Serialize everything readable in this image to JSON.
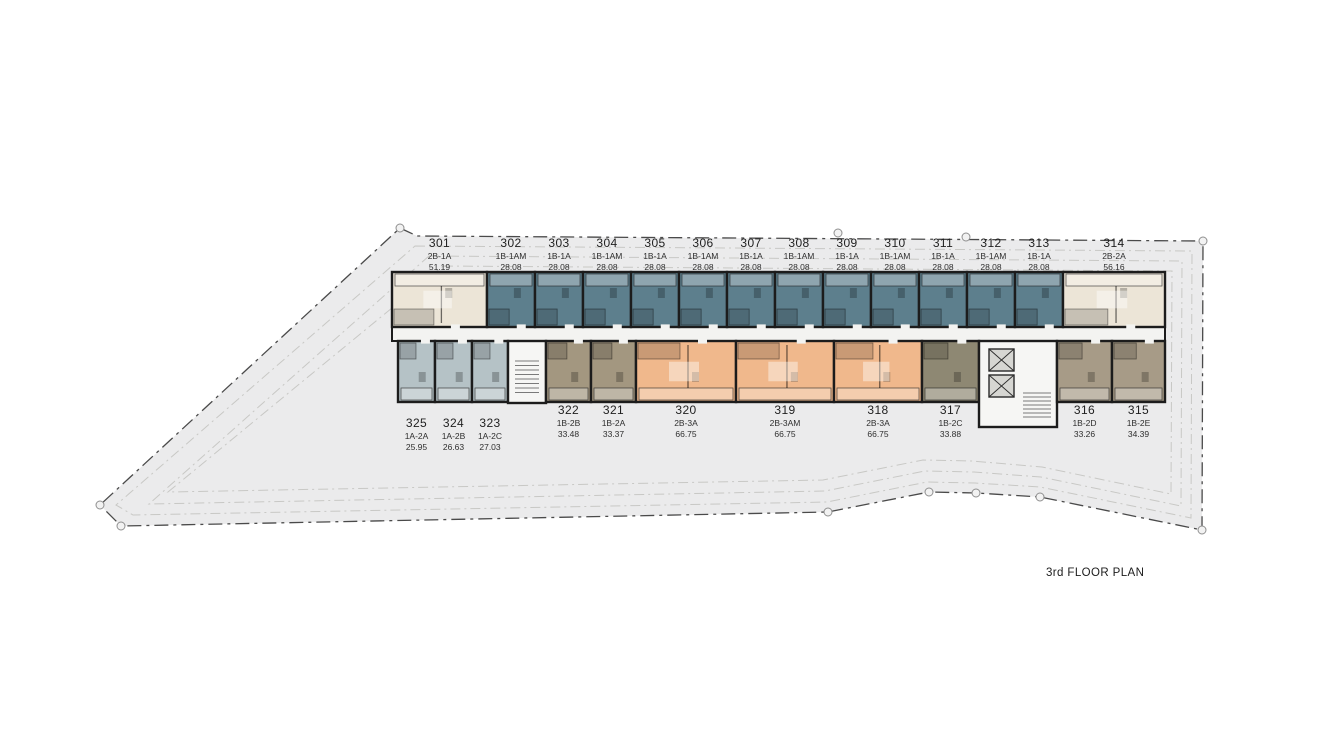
{
  "title": "3rd FLOOR PLAN",
  "colors": {
    "cream": "#ece5d7",
    "teal": "#5d7f8d",
    "bluegray": "#b5c2c6",
    "tan": "#a39780",
    "orange": "#f0b88c",
    "olive": "#8e8873",
    "brown": "#a79b87",
    "site_fill": "#ebebec",
    "site_border": "#4a4a4a",
    "corridor": "#f3f3f1",
    "core": "#f6f6f4",
    "wall": "#1c1c1c"
  },
  "top_units": [
    {
      "no": "301",
      "type": "2B-1A",
      "area": "51.19",
      "color": "cream"
    },
    {
      "no": "302",
      "type": "1B-1AM",
      "area": "28.08",
      "color": "teal"
    },
    {
      "no": "303",
      "type": "1B-1A",
      "area": "28.08",
      "color": "teal"
    },
    {
      "no": "304",
      "type": "1B-1AM",
      "area": "28.08",
      "color": "teal"
    },
    {
      "no": "305",
      "type": "1B-1A",
      "area": "28.08",
      "color": "teal"
    },
    {
      "no": "306",
      "type": "1B-1AM",
      "area": "28.08",
      "color": "teal"
    },
    {
      "no": "307",
      "type": "1B-1A",
      "area": "28.08",
      "color": "teal"
    },
    {
      "no": "308",
      "type": "1B-1AM",
      "area": "28.08",
      "color": "teal"
    },
    {
      "no": "309",
      "type": "1B-1A",
      "area": "28.08",
      "color": "teal"
    },
    {
      "no": "310",
      "type": "1B-1AM",
      "area": "28.08",
      "color": "teal"
    },
    {
      "no": "311",
      "type": "1B-1A",
      "area": "28.08",
      "color": "teal"
    },
    {
      "no": "312",
      "type": "1B-1AM",
      "area": "28.08",
      "color": "teal"
    },
    {
      "no": "313",
      "type": "1B-1A",
      "area": "28.08",
      "color": "teal"
    },
    {
      "no": "314",
      "type": "2B-2A",
      "area": "56.16",
      "color": "cream"
    }
  ],
  "bottom_units": [
    {
      "no": "325",
      "type": "1A-2A",
      "area": "25.95",
      "color": "bluegray"
    },
    {
      "no": "324",
      "type": "1A-2B",
      "area": "26.63",
      "color": "bluegray"
    },
    {
      "no": "323",
      "type": "1A-2C",
      "area": "27.03",
      "color": "bluegray"
    },
    {
      "no": "322",
      "type": "1B-2B",
      "area": "33.48",
      "color": "tan"
    },
    {
      "no": "321",
      "type": "1B-2A",
      "area": "33.37",
      "color": "tan"
    },
    {
      "no": "320",
      "type": "2B-3A",
      "area": "66.75",
      "color": "orange"
    },
    {
      "no": "319",
      "type": "2B-3AM",
      "area": "66.75",
      "color": "orange"
    },
    {
      "no": "318",
      "type": "2B-3A",
      "area": "66.75",
      "color": "orange"
    },
    {
      "no": "317",
      "type": "1B-2C",
      "area": "33.88",
      "color": "olive"
    },
    {
      "no": "316",
      "type": "1B-2D",
      "area": "33.26",
      "color": "brown"
    },
    {
      "no": "315",
      "type": "1B-2E",
      "area": "34.39",
      "color": "brown"
    }
  ]
}
